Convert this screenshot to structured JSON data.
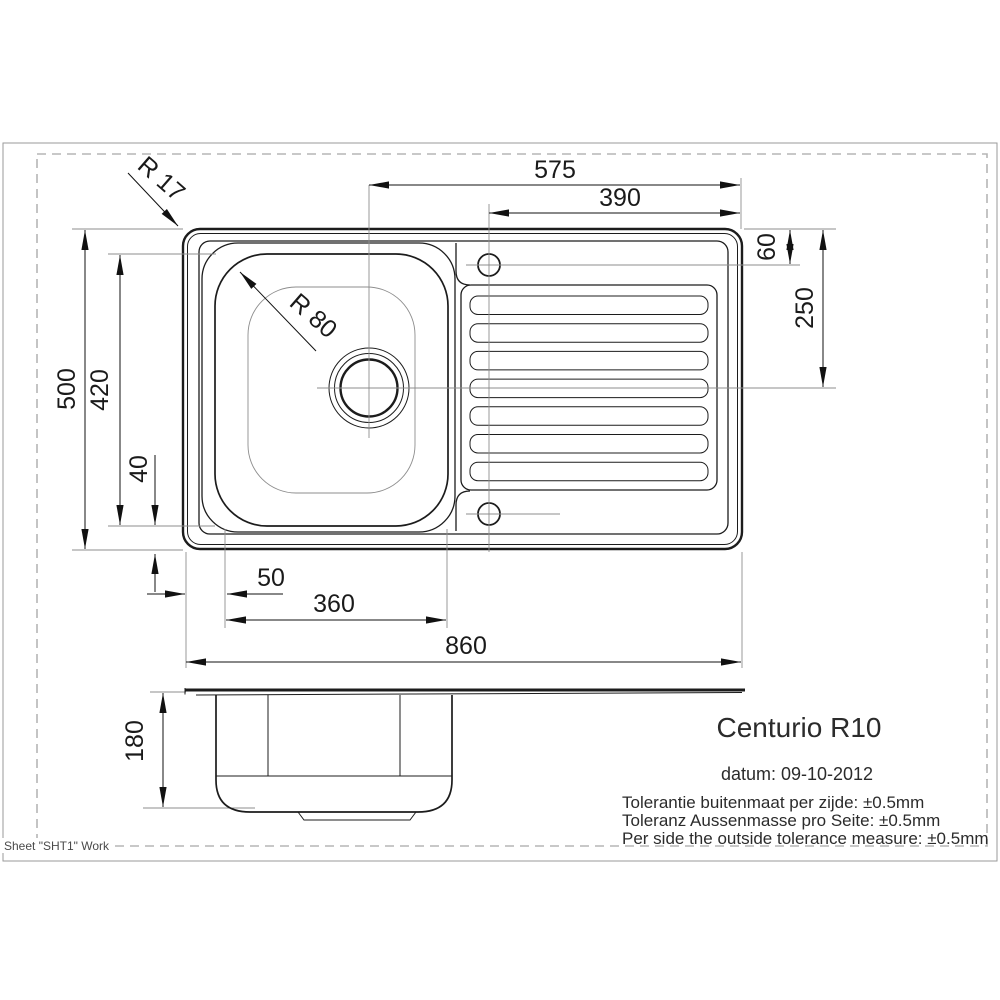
{
  "sheet": {
    "note": "Sheet \"SHT1\" Work"
  },
  "title_block": {
    "product": "Centurio R10",
    "date_line": "datum: 09-10-2012",
    "tolerance_nl": "Tolerantie buitenmaat per zijde: ±0.5mm",
    "tolerance_de": "Toleranz Aussenmasse pro Seite: ±0.5mm",
    "tolerance_en": "Per side the outside tolerance measure: ±0.5mm"
  },
  "dimensions": {
    "corner_radius": "R 17",
    "bowl_corner_radius": "R 80",
    "drain_to_right_edge": "575",
    "hole_to_right_edge": "390",
    "top_to_hole": "60",
    "top_to_drain_center": "250",
    "overall_depth": "500",
    "bowl_inner_depth": "420",
    "bowl_to_bottom_edge": "40",
    "left_edge_to_bowl": "50",
    "bowl_inner_width": "360",
    "overall_width": "860",
    "bowl_height_side": "180"
  },
  "colors": {
    "line": "#1c1c1c",
    "centerline": "#8d8d8d",
    "dashed_border": "#b5b5b5",
    "solid_border": "#9a9a9a",
    "background": "#ffffff"
  }
}
